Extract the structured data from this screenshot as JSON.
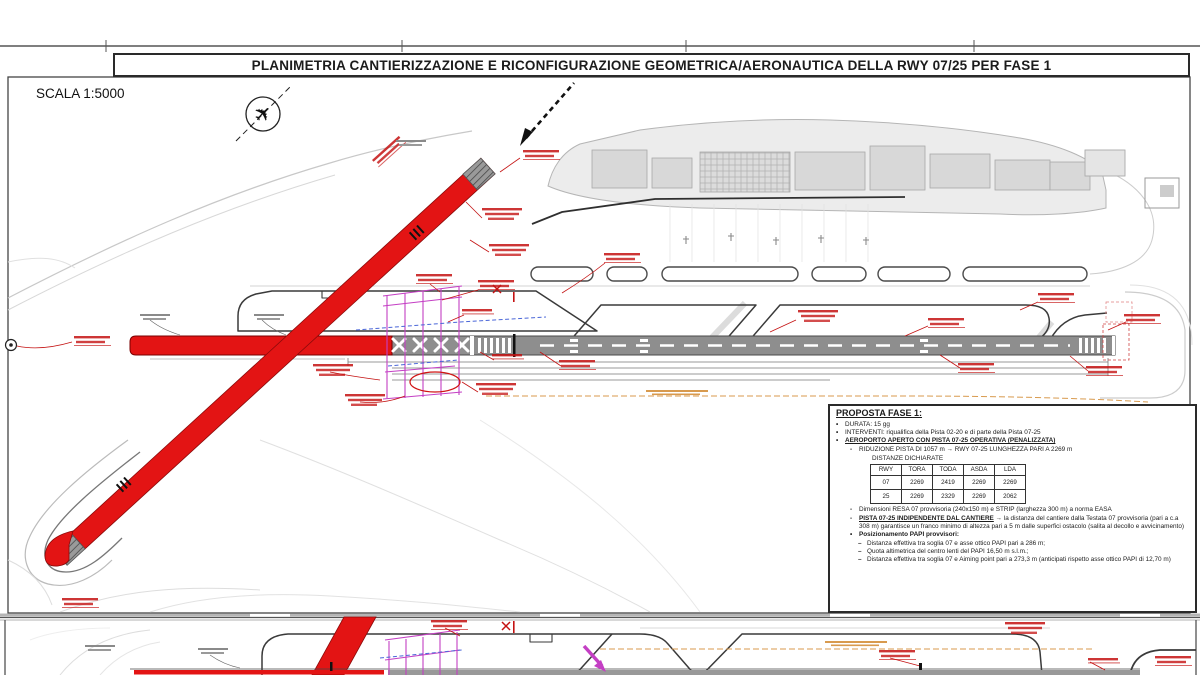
{
  "sheet1": {
    "title": "PLANIMETRIA CANTIERIZZAZIONE  E RICONFIGURAZIONE GEOMETRICA/AERONAUTICA DELLA RWY 07/25 PER FASE 1",
    "scale_label": "SCALA 1:5000",
    "proposta": {
      "heading": "PROPOSTA FASE 1:",
      "bullet_durata": "DURATA: 15 gg",
      "bullet_interventi": "INTERVENTI: riqualifica della Pista 02-20 e di parte della Pista 07-25",
      "bullet_aeroporto": "AEROPORTO APERTO CON PISTA 07-25 OPERATIVA (PENALIZZATA)",
      "riduzione": "RIDUZIONE PISTA DI 1057 m → RWY 07-25 LUNGHEZZA PARI A 2269 m",
      "distanze_heading": "DISTANZE DICHIARATE",
      "table": {
        "headers": [
          "RWY",
          "TORA",
          "TODA",
          "ASDA",
          "LDA"
        ],
        "rows": [
          [
            "07",
            "2269",
            "2419",
            "2269",
            "2269"
          ],
          [
            "25",
            "2269",
            "2329",
            "2269",
            "2062"
          ]
        ]
      },
      "dimensioni": "Dimensioni RESA 07 provvisoria (240x150 m) e STRIP (larghezza 300 m) a norma EASA",
      "pista_label": "PISTA 07-25 INDIPENDENTE DAL CANTIERE",
      "pista_rest": "→ la distanza del cantiere dalla Testata 07 provvisoria (pari a c.a 308 m) garantisce un franco minimo di altezza pari a 5 m dalle superfici ostacolo (salita al decollo e avvicinamento)",
      "papi_heading": "Posizionamento PAPI provvisori:",
      "papi_items": [
        "Distanza effettiva tra soglia 07 e asse ottico PAPI pari a 286 m;",
        "Quota altimetrica del centro lenti del PAPI 16,50 m s.l.m.;",
        "Distanza effettiva tra soglia 07 e Aiming point pari a 273,3 m (anticipati rispetto asse ottico PAPI di 12,70 m)"
      ]
    }
  },
  "icons": {
    "airplane": "✈"
  },
  "colors": {
    "closed_runway_red": "#e31414",
    "operative_runway_gray": "#8e8e8e",
    "construction_hatch_magenta": "#c43fc4",
    "annotation_red": "#c41212",
    "boundary_orange": "#d89a4e",
    "electric_line_blue": "#4a66d8"
  }
}
